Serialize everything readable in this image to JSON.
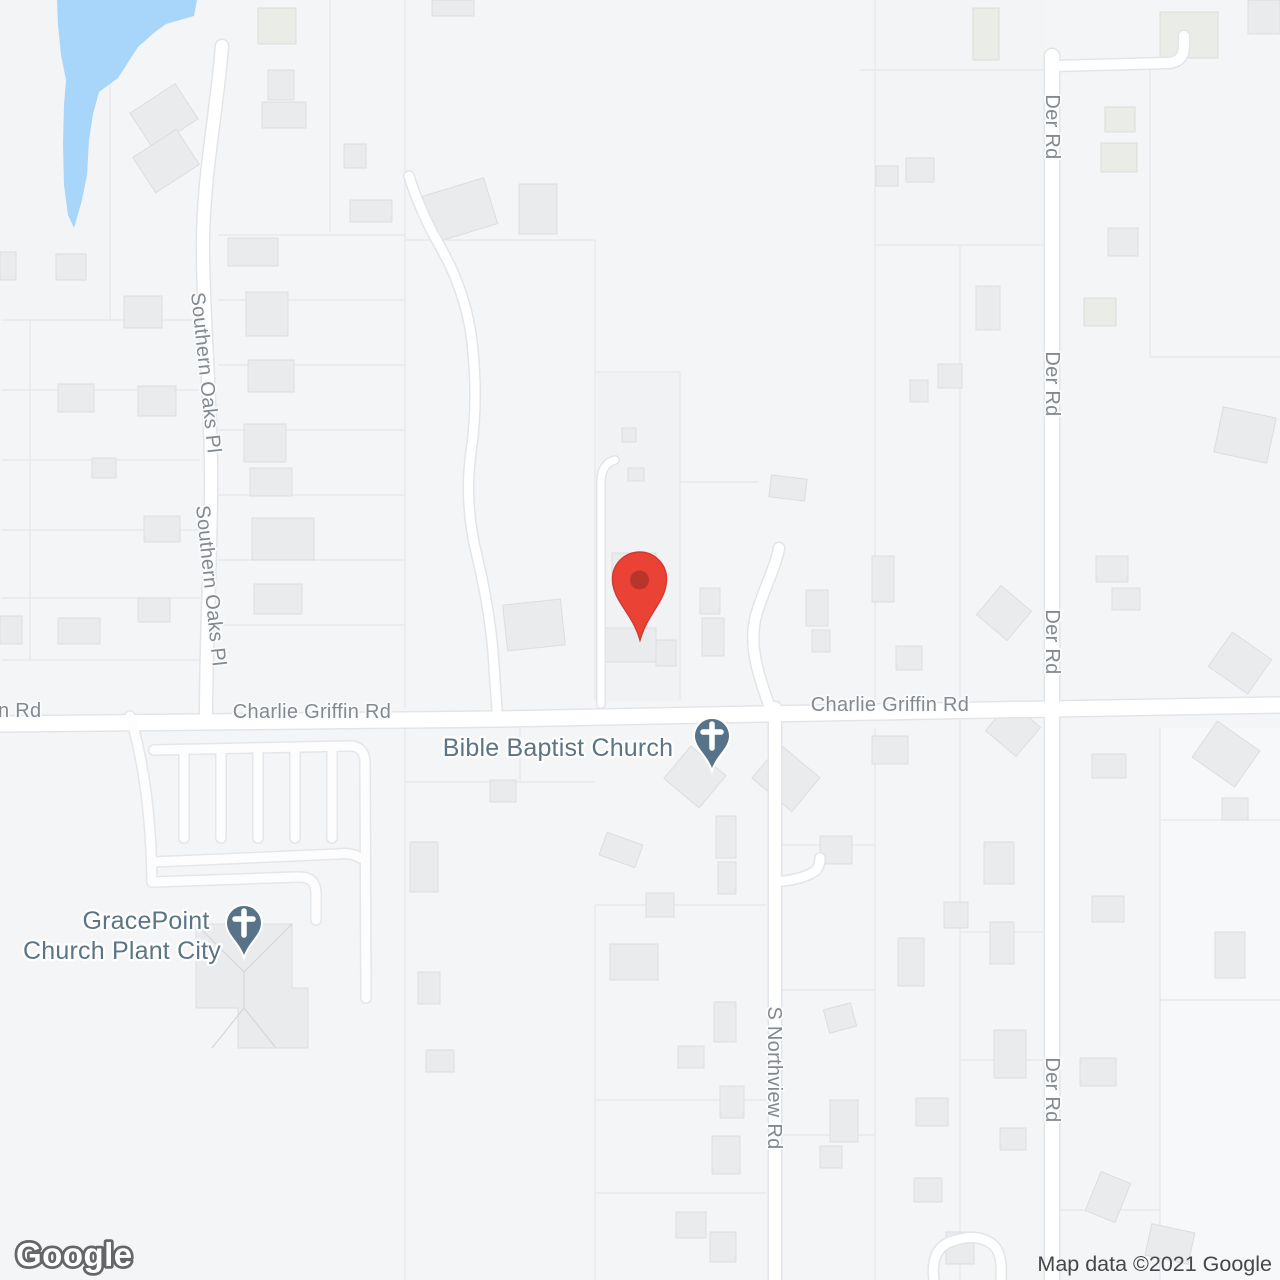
{
  "map_labels": {
    "roads": {
      "n_rd": "n Rd",
      "charlie_griffin_west": "Charlie Griffin Rd",
      "charlie_griffin_east": "Charlie Griffin Rd",
      "southern_oaks_north": "Southern Oaks Pl",
      "southern_oaks_south": "Southern Oaks Pl",
      "der_rd_1": "Der Rd",
      "der_rd_2": "Der Rd",
      "der_rd_3": "Der Rd",
      "der_rd_4": "Der Rd",
      "s_northview": "S Northview Rd"
    },
    "pois": {
      "bible_baptist": {
        "name": "Bible Baptist Church"
      },
      "gracepoint": {
        "name_line1": "GracePoint",
        "name_line2": "Church Plant City"
      }
    }
  },
  "marker": {
    "type": "destination-pin",
    "color": "#EA4335",
    "inner_color": "#B8352B"
  },
  "poi_pin_color": "#567389",
  "water_color": "#A8D5FA",
  "branding": {
    "logo_text": "Google"
  },
  "attribution": {
    "text": "Map data ©2021 Google"
  }
}
